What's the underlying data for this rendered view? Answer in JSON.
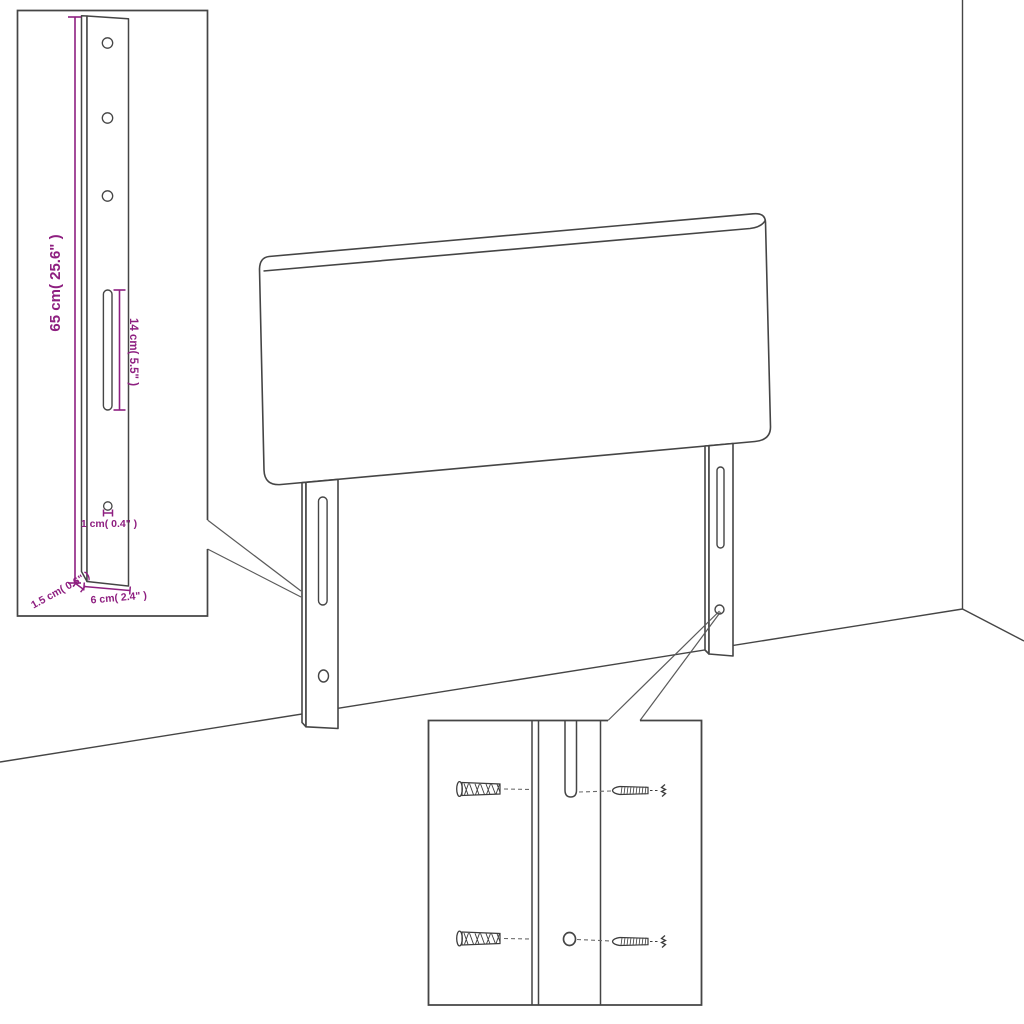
{
  "diagram": {
    "kind": "headboard wall-mounting dimension diagram",
    "views": {
      "main": "headboard with two mounting legs against wall corner",
      "leg_detail_inset": "enlarged mounting leg with holes and slot",
      "hardware_detail_inset": "wall plugs and screws aligned with leg slot and hole"
    }
  },
  "labels": {
    "height": "65 cm( 25.6\" )",
    "slot": "14 cm( 5.5\" )",
    "hole": "1 cm( 0.4\" )",
    "thickness": "1.5 cm( 0.6\" )",
    "width": "6 cm( 2.4\" )"
  },
  "colors": {
    "line": "#454545",
    "dimension": "#8e1f80",
    "guide_dash": "#6a6a6a",
    "background": "#ffffff"
  }
}
